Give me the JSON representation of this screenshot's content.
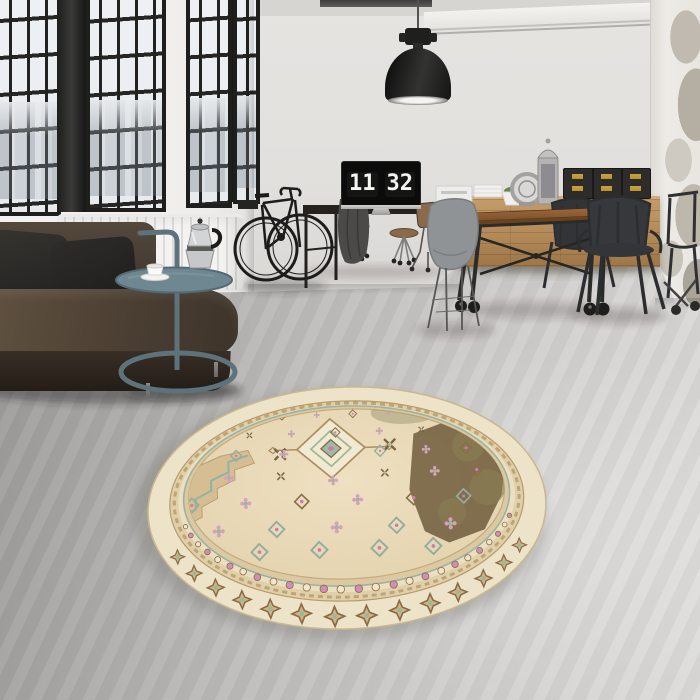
{
  "clock": {
    "hours": "11",
    "minutes": "32"
  },
  "palette": {
    "wall": "#e2e0dd",
    "window_frame": "#1e1e1d",
    "floor_concrete": "#c6c5c3",
    "sofa_leather": "#44382e",
    "pillow": "#262422",
    "side_table_metal": "#5d727b",
    "radiator": "#f4f3f1",
    "table_wood": "#8a5f38",
    "sideboard_wood": "#b08755",
    "chair_black": "#2e2f31",
    "chair_gray": "#8f9294",
    "box_brass": "#c8a23e",
    "rug_cream": "#e9d8b6",
    "rug_tan": "#d3bb90",
    "rug_brown": "#7a6143",
    "rug_green": "#9db894",
    "rug_teal": "#8fb3a4",
    "rug_pink": "#d79fc0"
  },
  "objects": {
    "windows": "steel-frame factory windows",
    "pendant_lamp": "black industrial pendant lamp",
    "radiator": "white wall radiator",
    "sofa": "dark brown leather sofa",
    "side_table": "round metal side table",
    "moka_pot": "stainless espresso maker",
    "coffee_cup": "white coffee cup and saucer",
    "bicycle": "black road bicycle",
    "monitor": "desktop monitor with flip clock",
    "desk": "black work desk",
    "jacket": "gray jacket draped on stool",
    "stools": "caster stools",
    "printer": "white printer",
    "dining_table": "industrial wood dining table on casters",
    "gray_chair": "gray shell chair",
    "black_chairs": "black metal armchairs",
    "sideboard": "wooden drawer sideboard",
    "storage_boxes": "black trunks with brass fittings",
    "plant": "potted green plant",
    "lanterns": "silver lanterns",
    "books": "stacked white books",
    "column": "distressed plaster column",
    "floor": "gray concrete floor",
    "rug": "round vintage beige medallion rug"
  }
}
